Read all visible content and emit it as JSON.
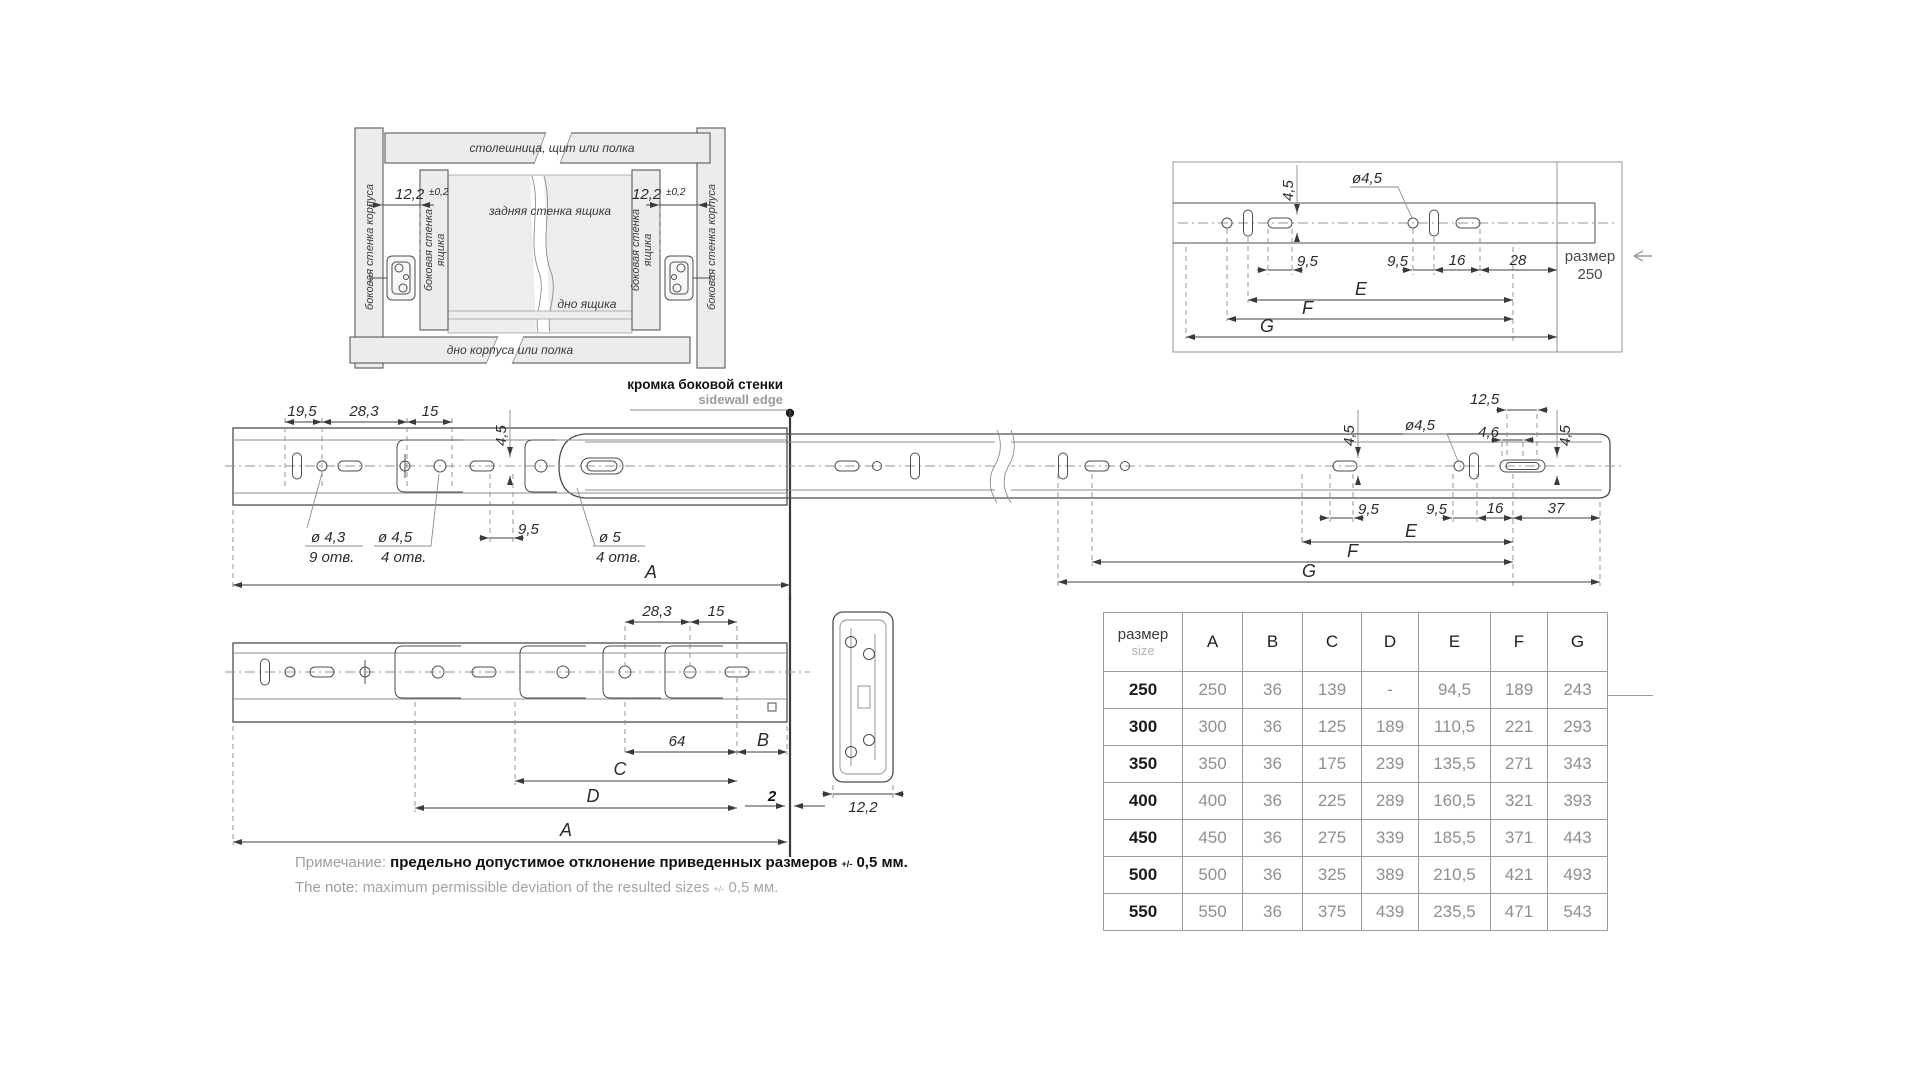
{
  "cabinet": {
    "top_panel": "столешница, щит или полка",
    "bottom_panel": "дно корпуса или полка",
    "cabinet_side_left": "боковая стенка корпуса",
    "cabinet_side_right": "боковая стенка корпуса",
    "drawer_side_l1": "боковая стенка",
    "drawer_side_l2": "ящика",
    "back_wall": "задняя стенка ящика",
    "drawer_bottom": "дно ящика",
    "offset_value": "12,2",
    "offset_tol": "±0,2"
  },
  "detail250": {
    "dim_45": "4,5",
    "dim_dia45": "ø4,5",
    "dim_95a": "9,5",
    "dim_95b": "9,5",
    "dim_16": "16",
    "dim_28": "28",
    "dim_E": "E",
    "dim_F": "F",
    "dim_G": "G",
    "size_word": "размер",
    "size_value": "250"
  },
  "main": {
    "edge_ru": "кромка боковой стенки",
    "edge_en": "sidewall edge",
    "dim_195": "19,5",
    "dim_283": "28,3",
    "dim_15": "15",
    "dim_45": "4,5",
    "hole1_d": "ø 4,3",
    "hole1_n": "9 отв.",
    "hole2_d": "ø 4,5",
    "hole2_n": "4 отв.",
    "dim_95": "9,5",
    "hole3_d": "ø 5",
    "hole3_n": "4 отв.",
    "dim_A": "A",
    "r_dim_45a": "4,5",
    "r_dim_dia45": "ø4,5",
    "r_dim_125": "12,5",
    "r_dim_46": "4,6",
    "r_dim_45b": "4,5",
    "r_dim_95a": "9,5",
    "r_dim_95b": "9,5",
    "r_dim_16": "16",
    "r_dim_37": "37",
    "r_dim_E": "E",
    "r_dim_F": "F",
    "r_dim_G": "G"
  },
  "drawer_rail": {
    "dim_283": "28,3",
    "dim_15": "15",
    "dim_64": "64",
    "dim_B": "B",
    "dim_C": "C",
    "dim_D": "D",
    "dim_A": "A",
    "dim_gap": "2"
  },
  "section": {
    "dim_width": "12,2"
  },
  "table": {
    "size_ru": "размер",
    "size_en": "size",
    "cols": [
      "A",
      "B",
      "C",
      "D",
      "E",
      "F",
      "G"
    ],
    "rows": [
      {
        "size": "250",
        "v": [
          "250",
          "36",
          "139",
          "-",
          "94,5",
          "189",
          "243"
        ]
      },
      {
        "size": "300",
        "v": [
          "300",
          "36",
          "125",
          "189",
          "110,5",
          "221",
          "293"
        ]
      },
      {
        "size": "350",
        "v": [
          "350",
          "36",
          "175",
          "239",
          "135,5",
          "271",
          "343"
        ]
      },
      {
        "size": "400",
        "v": [
          "400",
          "36",
          "225",
          "289",
          "160,5",
          "321",
          "393"
        ]
      },
      {
        "size": "450",
        "v": [
          "450",
          "36",
          "275",
          "339",
          "185,5",
          "371",
          "443"
        ]
      },
      {
        "size": "500",
        "v": [
          "500",
          "36",
          "325",
          "389",
          "210,5",
          "421",
          "493"
        ]
      },
      {
        "size": "550",
        "v": [
          "550",
          "36",
          "375",
          "439",
          "235,5",
          "471",
          "543"
        ]
      }
    ]
  },
  "note": {
    "label_ru": "Примечание:",
    "text_ru": "предельно допустимое отклонение приведенных размеров",
    "tol_small": "+/-",
    "tol_ru": "0,5 мм.",
    "label_en": "The note:",
    "text_en": "maximum permissible deviation of the resulted sizes",
    "tol_en": "0,5 мм."
  }
}
